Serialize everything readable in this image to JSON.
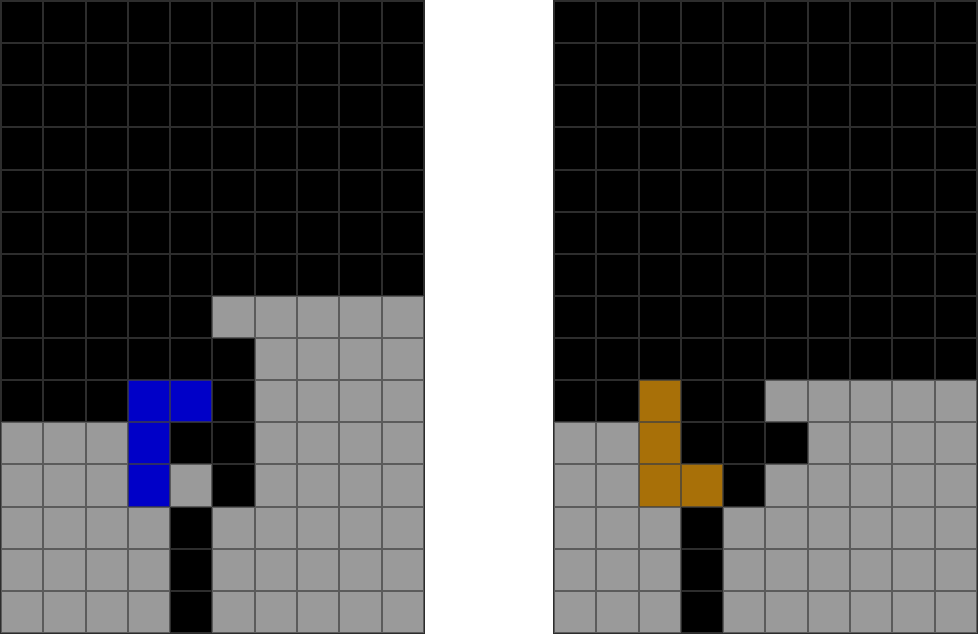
{
  "page": {
    "description": "two puzzle grids side by side on white background",
    "board_count": 2
  },
  "palette": {
    "k": "#000000",
    "g": "#9A9A9A",
    "b": "#0000C8",
    "o": "#A87008"
  },
  "colors": {
    "background": "#FFFFFF",
    "grid_line": "rgba(64,64,64,0.7)",
    "board_border": "#2D2D2D",
    "black_cell": "#000000",
    "gray_cell": "#9A9A9A",
    "blue_piece": "#0000C8",
    "orange_piece": "#A87008"
  },
  "boards": [
    {
      "name": "left-grid",
      "rows": 15,
      "cols": 10,
      "piece_color": "blue",
      "cells": [
        "kkkkkkkkkk",
        "kkkkkkkkkk",
        "kkkkkkkkkk",
        "kkkkkkkkkk",
        "kkkkkkkkkk",
        "kkkkkkkkkk",
        "kkkkkkkkkk",
        "kkkkkggggg",
        "kkkkkkgggg",
        "kkkbbkgggg",
        "gggbkkgggg",
        "gggbgkgggg",
        "ggggkggggg",
        "ggggkggggg",
        "ggggkggggg"
      ]
    },
    {
      "name": "right-grid",
      "rows": 15,
      "cols": 10,
      "piece_color": "orange",
      "cells": [
        "kkkkkkkkkk",
        "kkkkkkkkkk",
        "kkkkkkkkkk",
        "kkkkkkkkkk",
        "kkkkkkkkkk",
        "kkkkkkkkkk",
        "kkkkkkkkkk",
        "kkkkkkkkkk",
        "kkkkkkkkkk",
        "kkokkggggg",
        "ggokkkgggg",
        "ggookggggg",
        "gggkgggggg",
        "gggkgggggg",
        "gggkgggggg"
      ]
    }
  ]
}
